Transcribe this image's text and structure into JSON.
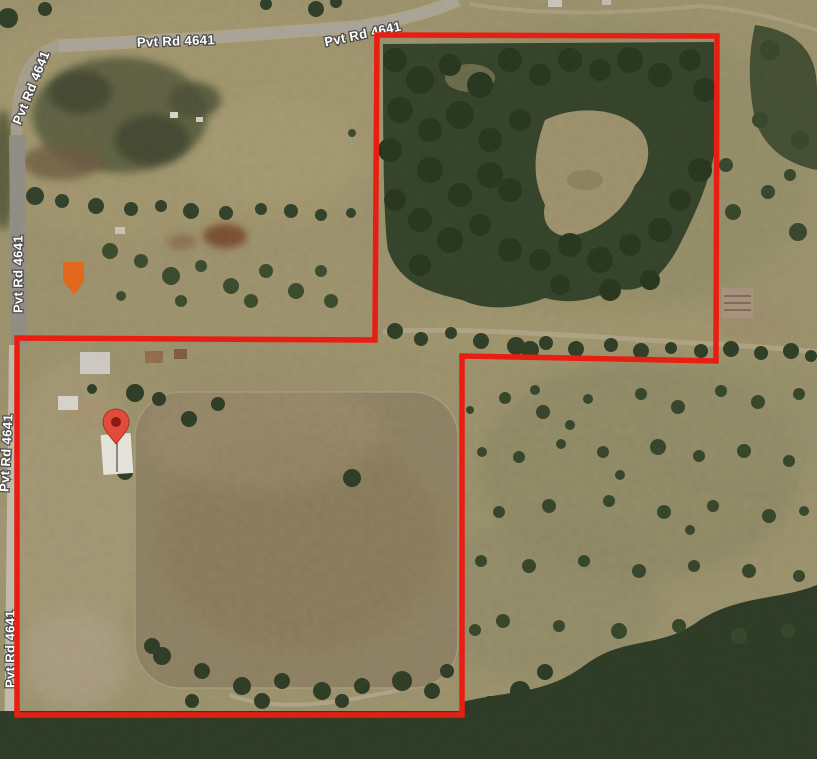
{
  "image_type": "satellite map with property boundary overlay",
  "map": {
    "road_labels": [
      {
        "text": "Pvt Rd 4641",
        "x": 176,
        "y": 42,
        "rotation": -2
      },
      {
        "text": "Pvt Rd 4641",
        "x": 363,
        "y": 35,
        "rotation": -12
      },
      {
        "text": "Pvt Rd 4641",
        "x": 32,
        "y": 88,
        "rotation": -68
      },
      {
        "text": "Pvt Rd 4641",
        "x": 19,
        "y": 274,
        "rotation": -90
      },
      {
        "text": "Pvt Rd 4641",
        "x": 7,
        "y": 453,
        "rotation": -87
      },
      {
        "text": "Pvt Rd 4641",
        "x": 11,
        "y": 649,
        "rotation": -90
      }
    ],
    "boundary": {
      "color": "#e81e12",
      "stroke_width": 5.5,
      "points": [
        [
          377,
          35
        ],
        [
          717,
          36
        ],
        [
          716,
          361
        ],
        [
          462,
          356
        ],
        [
          462,
          715
        ],
        [
          17,
          715
        ],
        [
          17,
          338
        ],
        [
          375,
          340
        ]
      ]
    },
    "pin": {
      "x": 116,
      "y": 444,
      "color": "#e04b3c",
      "inner_color": "#8c1a10"
    }
  },
  "colors": {
    "base_grass": "#99906c",
    "forest": "#34422b",
    "road": "#a7a298",
    "label_fill": "#ffffff",
    "label_outline": "#4f4f4f"
  },
  "scenery": {
    "buildings": [
      {
        "name": "orange-roof-house",
        "type": "polygon",
        "points": [
          [
            63,
            262
          ],
          [
            84,
            262
          ],
          [
            84,
            281
          ],
          [
            74,
            295
          ],
          [
            63,
            281
          ]
        ],
        "color": "#e2661c"
      },
      {
        "name": "white-house",
        "type": "rect",
        "x": 80,
        "y": 352,
        "w": 30,
        "h": 22,
        "color": "#cdc9c2",
        "rotation": 0
      },
      {
        "name": "brown-shed",
        "type": "rect",
        "x": 145,
        "y": 351,
        "w": 18,
        "h": 12,
        "color": "#8f6b4e",
        "rotation": 0
      },
      {
        "name": "brown-shed-2",
        "type": "rect",
        "x": 174,
        "y": 349,
        "w": 13,
        "h": 10,
        "color": "#7a5a40",
        "rotation": 0
      },
      {
        "name": "white-shed",
        "type": "rect",
        "x": 58,
        "y": 396,
        "w": 20,
        "h": 14,
        "color": "#d6d3cb",
        "rotation": 0
      },
      {
        "name": "white-barn",
        "type": "rect",
        "x": 102,
        "y": 434,
        "w": 30,
        "h": 40,
        "color": "#e5e3dc",
        "rotation": -4,
        "ridge": "vertical"
      },
      {
        "name": "gray-barn",
        "type": "rect",
        "x": 722,
        "y": 288,
        "w": 31,
        "h": 30,
        "color": "#a5907c",
        "rotation": 0,
        "ridge": "horizontal"
      },
      {
        "name": "top-edge-structure",
        "type": "rect",
        "x": 548,
        "y": 0,
        "w": 14,
        "h": 7,
        "color": "#c9c4ba",
        "rotation": 0
      },
      {
        "name": "top-edge-structure-2",
        "type": "rect",
        "x": 602,
        "y": 0,
        "w": 9,
        "h": 5,
        "color": "#bfbab0",
        "rotation": 0
      },
      {
        "name": "white-speck",
        "type": "rect",
        "x": 170,
        "y": 112,
        "w": 8,
        "h": 6,
        "color": "#d8d4c9",
        "rotation": 0
      },
      {
        "name": "white-speck-2",
        "type": "rect",
        "x": 196,
        "y": 117,
        "w": 7,
        "h": 5,
        "color": "#d0ccc1",
        "rotation": 0
      },
      {
        "name": "white-speck-3",
        "type": "rect",
        "x": 115,
        "y": 227,
        "w": 10,
        "h": 7,
        "color": "#c8c3b7",
        "rotation": 0
      }
    ],
    "tree_groups": [
      {
        "name": "top-edge-trees",
        "color": "#2f3e28",
        "trees": [
          [
            8,
            18,
            10
          ],
          [
            45,
            9,
            7
          ],
          [
            266,
            4,
            6
          ],
          [
            316,
            9,
            8
          ],
          [
            336,
            2,
            6
          ]
        ]
      },
      {
        "name": "upper-left-tree-row",
        "color": "#31402a",
        "trees": [
          [
            35,
            196,
            9
          ],
          [
            62,
            201,
            7
          ],
          [
            96,
            206,
            8
          ],
          [
            131,
            209,
            7
          ],
          [
            161,
            206,
            6
          ],
          [
            191,
            211,
            8
          ],
          [
            226,
            213,
            7
          ],
          [
            261,
            209,
            6
          ],
          [
            291,
            211,
            7
          ],
          [
            321,
            215,
            6
          ],
          [
            351,
            213,
            5
          ]
        ]
      },
      {
        "name": "upper-left-scrub",
        "color": "#3a4a2e",
        "trees": [
          [
            110,
            251,
            8
          ],
          [
            141,
            261,
            7
          ],
          [
            171,
            276,
            9
          ],
          [
            201,
            266,
            6
          ],
          [
            231,
            286,
            8
          ],
          [
            266,
            271,
            7
          ],
          [
            296,
            291,
            8
          ],
          [
            321,
            271,
            6
          ],
          [
            251,
            301,
            7
          ],
          [
            181,
            301,
            6
          ],
          [
            121,
            296,
            5
          ],
          [
            331,
            301,
            7
          ],
          [
            352,
            133,
            4
          ]
        ]
      },
      {
        "name": "upper-right-forest-canopy",
        "color": "#283620",
        "trees": [
          [
            395,
            60,
            12
          ],
          [
            420,
            80,
            14
          ],
          [
            450,
            65,
            11
          ],
          [
            480,
            85,
            13
          ],
          [
            510,
            60,
            12
          ],
          [
            540,
            75,
            11
          ],
          [
            570,
            60,
            12
          ],
          [
            600,
            70,
            11
          ],
          [
            630,
            60,
            13
          ],
          [
            660,
            75,
            12
          ],
          [
            690,
            60,
            11
          ],
          [
            705,
            90,
            12
          ],
          [
            400,
            110,
            13
          ],
          [
            430,
            130,
            12
          ],
          [
            460,
            115,
            14
          ],
          [
            490,
            140,
            12
          ],
          [
            520,
            120,
            11
          ],
          [
            430,
            170,
            13
          ],
          [
            460,
            195,
            12
          ],
          [
            490,
            175,
            13
          ],
          [
            420,
            220,
            12
          ],
          [
            450,
            240,
            13
          ],
          [
            480,
            225,
            11
          ],
          [
            510,
            250,
            12
          ],
          [
            540,
            260,
            11
          ],
          [
            570,
            245,
            12
          ],
          [
            600,
            260,
            13
          ],
          [
            630,
            245,
            11
          ],
          [
            660,
            230,
            12
          ],
          [
            680,
            200,
            11
          ],
          [
            700,
            170,
            12
          ],
          [
            510,
            190,
            12
          ],
          [
            420,
            265,
            11
          ],
          [
            390,
            150,
            12
          ],
          [
            395,
            200,
            11
          ],
          [
            560,
            285,
            10
          ],
          [
            610,
            290,
            11
          ],
          [
            650,
            280,
            10
          ]
        ]
      },
      {
        "name": "upper-bottom-tree-row",
        "color": "#2f3d27",
        "trees": [
          [
            395,
            331,
            8
          ],
          [
            421,
            339,
            7
          ],
          [
            451,
            333,
            6
          ],
          [
            481,
            341,
            8
          ],
          [
            516,
            346,
            9
          ],
          [
            530,
            350,
            9
          ],
          [
            546,
            343,
            7
          ],
          [
            576,
            349,
            8
          ],
          [
            611,
            345,
            7
          ],
          [
            641,
            351,
            8
          ],
          [
            671,
            348,
            6
          ],
          [
            701,
            351,
            7
          ],
          [
            731,
            349,
            8
          ],
          [
            761,
            353,
            7
          ],
          [
            791,
            351,
            8
          ],
          [
            811,
            356,
            6
          ]
        ]
      },
      {
        "name": "right-strip-trees",
        "color": "#37462c",
        "trees": [
          [
            733,
            212,
            8
          ],
          [
            768,
            192,
            7
          ],
          [
            798,
            232,
            9
          ],
          [
            726,
            165,
            7
          ],
          [
            790,
            175,
            6
          ],
          [
            770,
            50,
            10
          ],
          [
            800,
            140,
            9
          ],
          [
            760,
            120,
            8
          ]
        ]
      },
      {
        "name": "homestead-trees",
        "color": "#2e3c27",
        "trees": [
          [
            135,
            393,
            9
          ],
          [
            159,
            399,
            7
          ],
          [
            189,
            419,
            8
          ],
          [
            92,
            389,
            5
          ],
          [
            125,
            472,
            8
          ],
          [
            218,
            404,
            7
          ]
        ]
      },
      {
        "name": "lower-right-scatter",
        "color": "#36452b",
        "trees": [
          [
            505,
            398,
            6
          ],
          [
            543,
            412,
            7
          ],
          [
            588,
            399,
            5
          ],
          [
            641,
            394,
            6
          ],
          [
            678,
            407,
            7
          ],
          [
            721,
            391,
            6
          ],
          [
            758,
            402,
            7
          ],
          [
            799,
            394,
            6
          ],
          [
            482,
            452,
            5
          ],
          [
            519,
            457,
            6
          ],
          [
            561,
            444,
            5
          ],
          [
            603,
            452,
            6
          ],
          [
            658,
            447,
            8
          ],
          [
            699,
            456,
            6
          ],
          [
            744,
            451,
            7
          ],
          [
            789,
            461,
            6
          ],
          [
            499,
            512,
            6
          ],
          [
            549,
            506,
            7
          ],
          [
            609,
            501,
            6
          ],
          [
            664,
            512,
            7
          ],
          [
            713,
            506,
            6
          ],
          [
            769,
            516,
            7
          ],
          [
            804,
            511,
            5
          ],
          [
            481,
            561,
            6
          ],
          [
            529,
            566,
            7
          ],
          [
            584,
            561,
            6
          ],
          [
            639,
            571,
            7
          ],
          [
            694,
            566,
            6
          ],
          [
            749,
            571,
            7
          ],
          [
            799,
            576,
            6
          ],
          [
            503,
            621,
            7
          ],
          [
            559,
            626,
            6
          ],
          [
            619,
            631,
            8
          ],
          [
            679,
            626,
            7
          ],
          [
            739,
            636,
            8
          ],
          [
            788,
            631,
            7
          ],
          [
            535,
            390,
            5
          ],
          [
            570,
            425,
            5
          ],
          [
            620,
            475,
            5
          ],
          [
            690,
            530,
            5
          ],
          [
            470,
            410,
            4
          ],
          [
            475,
            630,
            6
          ]
        ]
      },
      {
        "name": "pasture-trees",
        "color": "#2e3c26",
        "trees": [
          [
            352,
            478,
            9
          ],
          [
            152,
            646,
            8
          ],
          [
            162,
            656,
            9
          ],
          [
            202,
            671,
            8
          ],
          [
            242,
            686,
            9
          ],
          [
            282,
            681,
            8
          ],
          [
            322,
            691,
            9
          ],
          [
            362,
            686,
            8
          ],
          [
            402,
            681,
            10
          ],
          [
            432,
            691,
            8
          ],
          [
            447,
            671,
            7
          ],
          [
            192,
            701,
            7
          ],
          [
            262,
            701,
            8
          ],
          [
            342,
            701,
            7
          ]
        ]
      },
      {
        "name": "bottom-forest-trees",
        "color": "#2c3a25",
        "trees": [
          [
            520,
            691,
            10
          ],
          [
            561,
            701,
            9
          ],
          [
            601,
            681,
            12
          ],
          [
            651,
            661,
            11
          ],
          [
            701,
            671,
            10
          ],
          [
            701,
            641,
            9
          ],
          [
            761,
            651,
            12
          ],
          [
            801,
            641,
            10
          ],
          [
            781,
            691,
            11
          ],
          [
            731,
            701,
            12
          ],
          [
            671,
            711,
            10
          ],
          [
            621,
            701,
            9
          ],
          [
            490,
            705,
            9
          ],
          [
            545,
            672,
            8
          ]
        ]
      }
    ]
  }
}
